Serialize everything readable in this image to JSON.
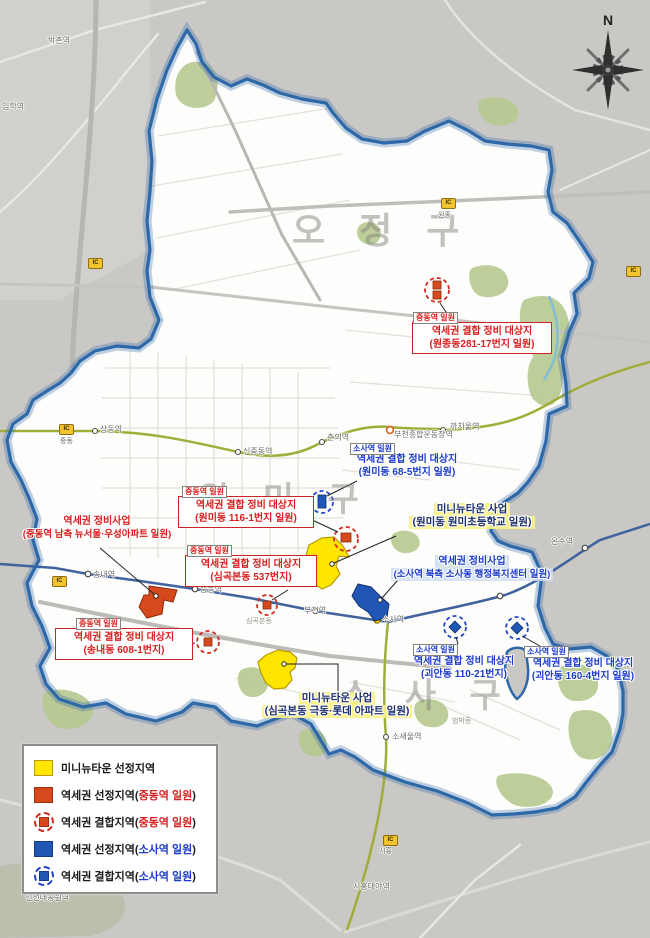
{
  "compass": {
    "label": "N"
  },
  "watermarks": {
    "north": "오 정 구",
    "central": "원 미 구",
    "south": "소 사 구"
  },
  "area_labels": {
    "simgokbondong": "심곡본동",
    "beombakdong": "범박동"
  },
  "stations": {
    "bakchon": "박촌역",
    "imhak": "임학역",
    "sangdong": "상동역",
    "sinjungdong": "신중동역",
    "chunui": "춘의역",
    "stadium": "부천종합운동장역",
    "kkachiul": "까치울역",
    "songnae": "송내역",
    "jungdong": "중동역",
    "bucheon": "부천역",
    "sosa": "소사역",
    "sosaeul": "소새울역",
    "siheungdaeya": "시흥대야역",
    "onsu": "온수역",
    "incheonpark": "인천대공원역"
  },
  "ic": {
    "badge": "IC",
    "jungdong": "중동",
    "wonjong": "원종",
    "siheung": "시흥"
  },
  "callouts": {
    "wonjong": {
      "tag": "중동역 일원",
      "line1": "역세권 결합 정비 대상지",
      "line2": "(원종동281-17번지 일원)"
    },
    "wonmi68": {
      "tag": "소사역 일원",
      "line1": "역세권 결합 정비 대상지",
      "line2": "(원미동 68-5번지 일원)"
    },
    "minitown_wonmi": {
      "line1": "미니뉴타운 사업",
      "line2": "(원미동 원미초등학교 일원)"
    },
    "jungdong_south": {
      "line1": "역세권 정비사업",
      "line2": "(중동역 남측 뉴서울·우성아파트 일원)"
    },
    "wonmi116": {
      "tag": "중동역 일원",
      "line1": "역세권 결합 정비 대상지",
      "line2": "(원미동 116-1번지 일원)"
    },
    "simgok537": {
      "tag": "중동역 일원",
      "line1": "역세권 결합 정비 대상지",
      "line2": "(심곡본동 537번지)"
    },
    "songnae608": {
      "tag": "중동역 일원",
      "line1": "역세권 결합 정비 대상지",
      "line2": "(송내동 608-1번지)"
    },
    "sosa_north": {
      "line1": "역세권 정비사업",
      "line2": "(소사역 북측 소사동 행정복지센터 일원)"
    },
    "goean110": {
      "tag": "소사역 일원",
      "line1": "역세권 결합 정비 대상지",
      "line2": "(괴안동 110-21번지)"
    },
    "goean160": {
      "tag": "소사역 일원",
      "line1": "역세권 결합 정비 대상지",
      "line2": "(괴안동 160-4번지 일원)"
    },
    "minitown_simgok": {
      "line1": "미니뉴타운 사업",
      "line2": "(심곡본동 극동·롯데 아파트 일원)"
    }
  },
  "legend": {
    "items": [
      {
        "prefix": "미니뉴타운 선정지역",
        "hl": "",
        "suffix": ""
      },
      {
        "prefix": "역세권 선정지역(",
        "hl": "중동역 일원",
        "suffix": ")"
      },
      {
        "prefix": "역세권 결합지역(",
        "hl": "중동역 일원",
        "suffix": ")"
      },
      {
        "prefix": "역세권 선정지역(",
        "hl": "소사역 일원",
        "suffix": ")"
      },
      {
        "prefix": "역세권 결합지역(",
        "hl": "소사역 일원",
        "suffix": ")"
      }
    ]
  },
  "colors": {
    "jungdong_red": "#d81e1e",
    "sosa_blue": "#1c3bcc",
    "minitown_navy": "#1b2e6e",
    "zone_yellow": "#ffe600",
    "zone_orange": "#d5491d",
    "zone_blue": "#2156b4",
    "boundary_blue": "#2d68a8",
    "outside_grey": "#cac8c5",
    "inside_white": "#fdfdfb"
  }
}
